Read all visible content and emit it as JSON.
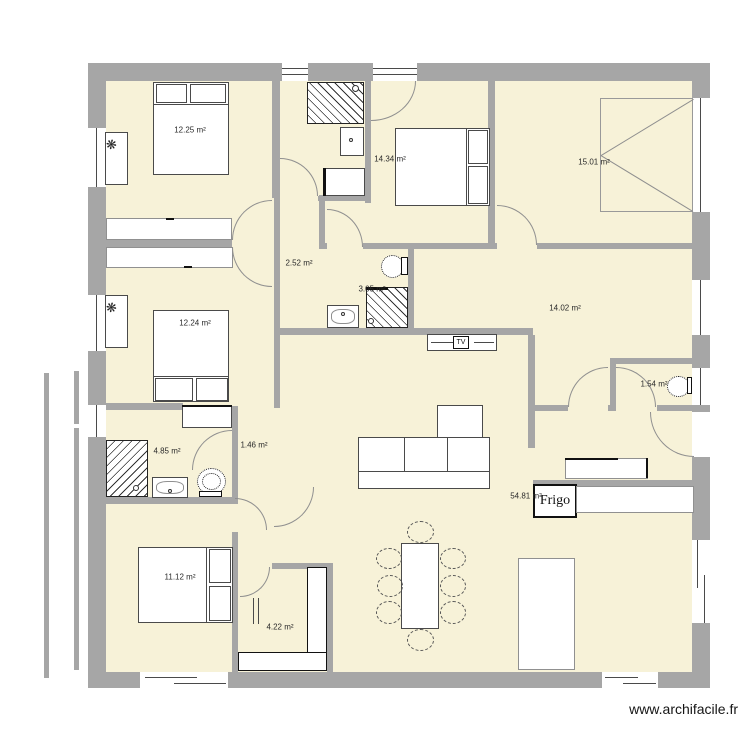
{
  "watermark": "www.archifacile.fr",
  "plan": {
    "rooms": [
      {
        "name": "bedroom-1",
        "area_label": "12.25 m²"
      },
      {
        "name": "bedroom-2",
        "area_label": "12.24 m²"
      },
      {
        "name": "bedroom-3",
        "area_label": "14.34 m²"
      },
      {
        "name": "garage",
        "area_label": "15.01 m²"
      },
      {
        "name": "hallway",
        "area_label": "2.52 m²"
      },
      {
        "name": "shower-room",
        "area_label": "3.05 m²"
      },
      {
        "name": "master-bedroom",
        "area_label": "14.02 m²"
      },
      {
        "name": "wc",
        "area_label": "1.54 m²"
      },
      {
        "name": "bathroom",
        "area_label": "4.85 m²"
      },
      {
        "name": "hall-2",
        "area_label": "1.46 m²"
      },
      {
        "name": "living-kitchen",
        "area_label": "54.81 m²"
      },
      {
        "name": "bedroom-4",
        "area_label": "11.12 m²"
      },
      {
        "name": "storage",
        "area_label": "4.22 m²"
      }
    ],
    "appliances": {
      "fridge_label": "Frigo",
      "tv_label": "TV"
    },
    "colors": {
      "floor": "#f7f2d8",
      "wall": "#a6a6a6"
    }
  }
}
